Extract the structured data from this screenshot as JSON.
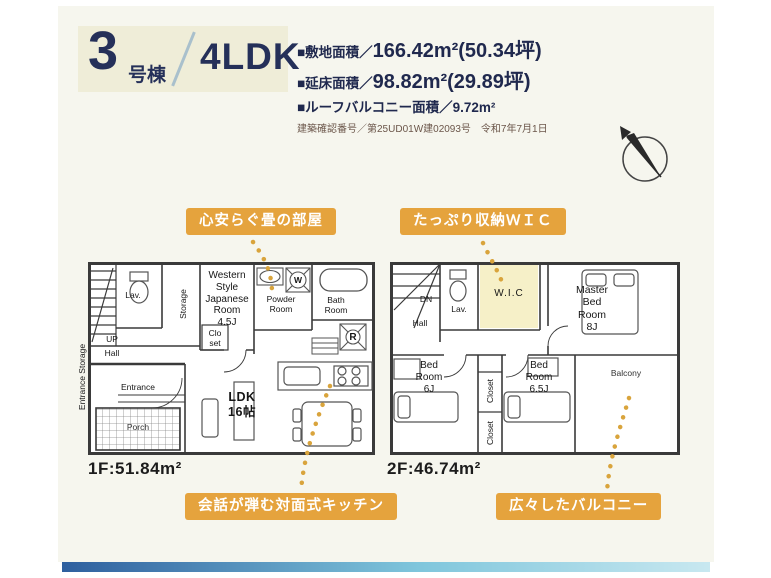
{
  "colors": {
    "accent_orange": "#E5A33D",
    "navy_text": "#20294E",
    "badge_bg": "#EFEDD8",
    "wic_highlight": "#F6F0C8",
    "footer_bar_left": "#2E5F9E",
    "footer_bar_right": "#C8E8F0"
  },
  "header": {
    "unit_number": "3",
    "unit_suffix": "号棟",
    "layout": "4LDK",
    "specs": [
      {
        "label": "■敷地面積／",
        "value": "166.42m²(50.34坪)"
      },
      {
        "label": "■延床面積／",
        "value": "98.82m²(29.89坪)"
      },
      {
        "label": "■ルーフバルコニー面積／",
        "value": "9.72m²"
      }
    ],
    "approval": "建築確認番号／第25UD01W建02093号　令和7年7月1日"
  },
  "callouts": {
    "tatami": "心安らぐ畳の部屋",
    "wic": "たっぷり収納ＷＩＣ",
    "kitchen": "会話が弾む対面式キッチン",
    "balcony": "広々したバルコニー"
  },
  "floor1": {
    "area": "1F:51.84m²",
    "rooms": {
      "lav": "Lav.",
      "storage": "Storage",
      "japanese_room": "Western\nStyle\nJapanese\nRoom\n4.5J",
      "powder_room": "Powder\nRoom",
      "bath_room": "Bath\nRoom",
      "closet": "Clo\nset",
      "up": "UP",
      "hall": "Hall",
      "ldk": "LDK\n16帖",
      "entrance": "Entrance",
      "entrance_storage": "Entrance Storage",
      "porch": "Porch",
      "washer": "W",
      "fridge": "R"
    }
  },
  "floor2": {
    "area": "2F:46.74m²",
    "rooms": {
      "dn": "DN",
      "hall": "Hall",
      "lav": "Lav.",
      "wic": "W.I.C",
      "master": "Master\nBed\nRoom\n8J",
      "bedroom1": "Bed\nRoom\n6J",
      "closet1": "Closet",
      "closet2": "Closet",
      "bedroom2": "Bed\nRoom\n6.5J",
      "balcony": "Balcony"
    }
  }
}
